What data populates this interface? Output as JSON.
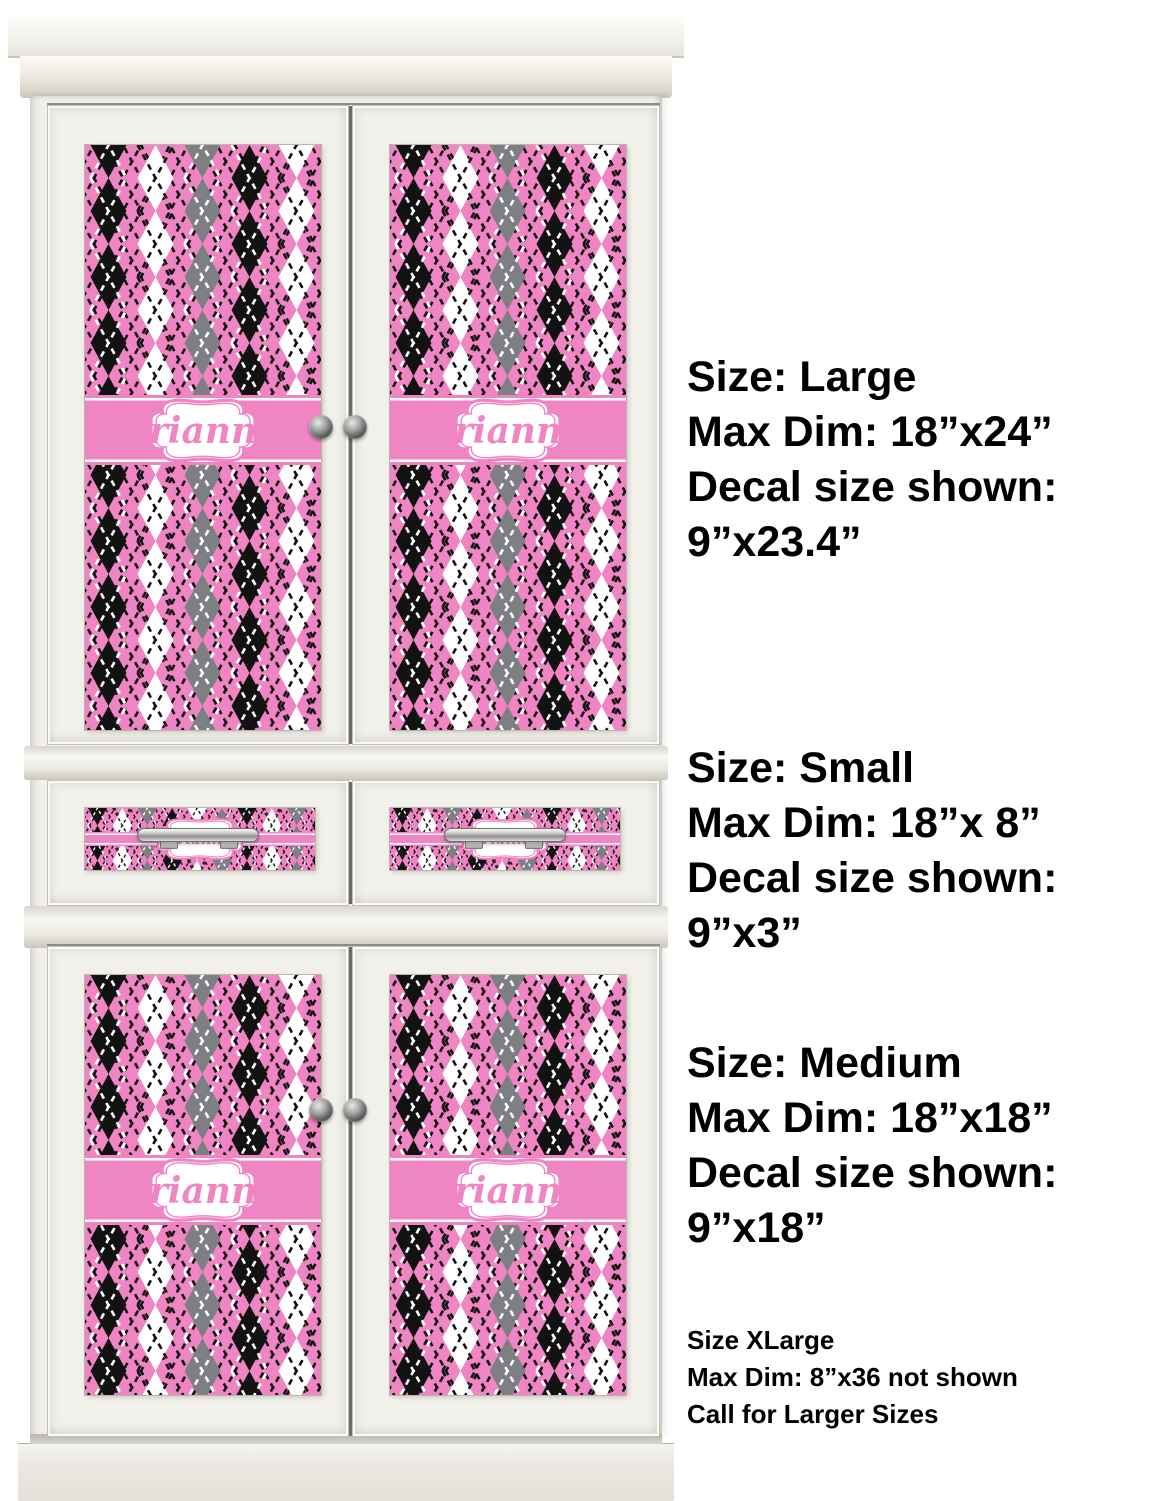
{
  "product": {
    "personalized_name": "arianna"
  },
  "colors": {
    "page_bg": "#ffffff",
    "decal_pink": "#f085c4",
    "decal_black": "#121212",
    "decal_gray": "#7d7f82",
    "decal_white": "#ffffff",
    "cabinet_face": "#f1f0ea",
    "text_color": "#000000"
  },
  "annotations": {
    "blocks": [
      {
        "lines": [
          "Size: Large",
          "Max Dim: 18”x24”",
          "Decal size shown:",
          "9”x23.4”"
        ]
      },
      {
        "lines": [
          "Size: Small",
          "Max Dim: 18”x 8”",
          "Decal size shown:",
          "9”x3”"
        ]
      },
      {
        "lines": [
          "Size: Medium",
          "Max Dim: 18”x18”",
          "Decal size shown:",
          "9”x18”"
        ]
      },
      {
        "lines": [
          "Size XLarge",
          "Max Dim: 8”x36 not shown",
          "Call for Larger Sizes"
        ]
      }
    ]
  }
}
